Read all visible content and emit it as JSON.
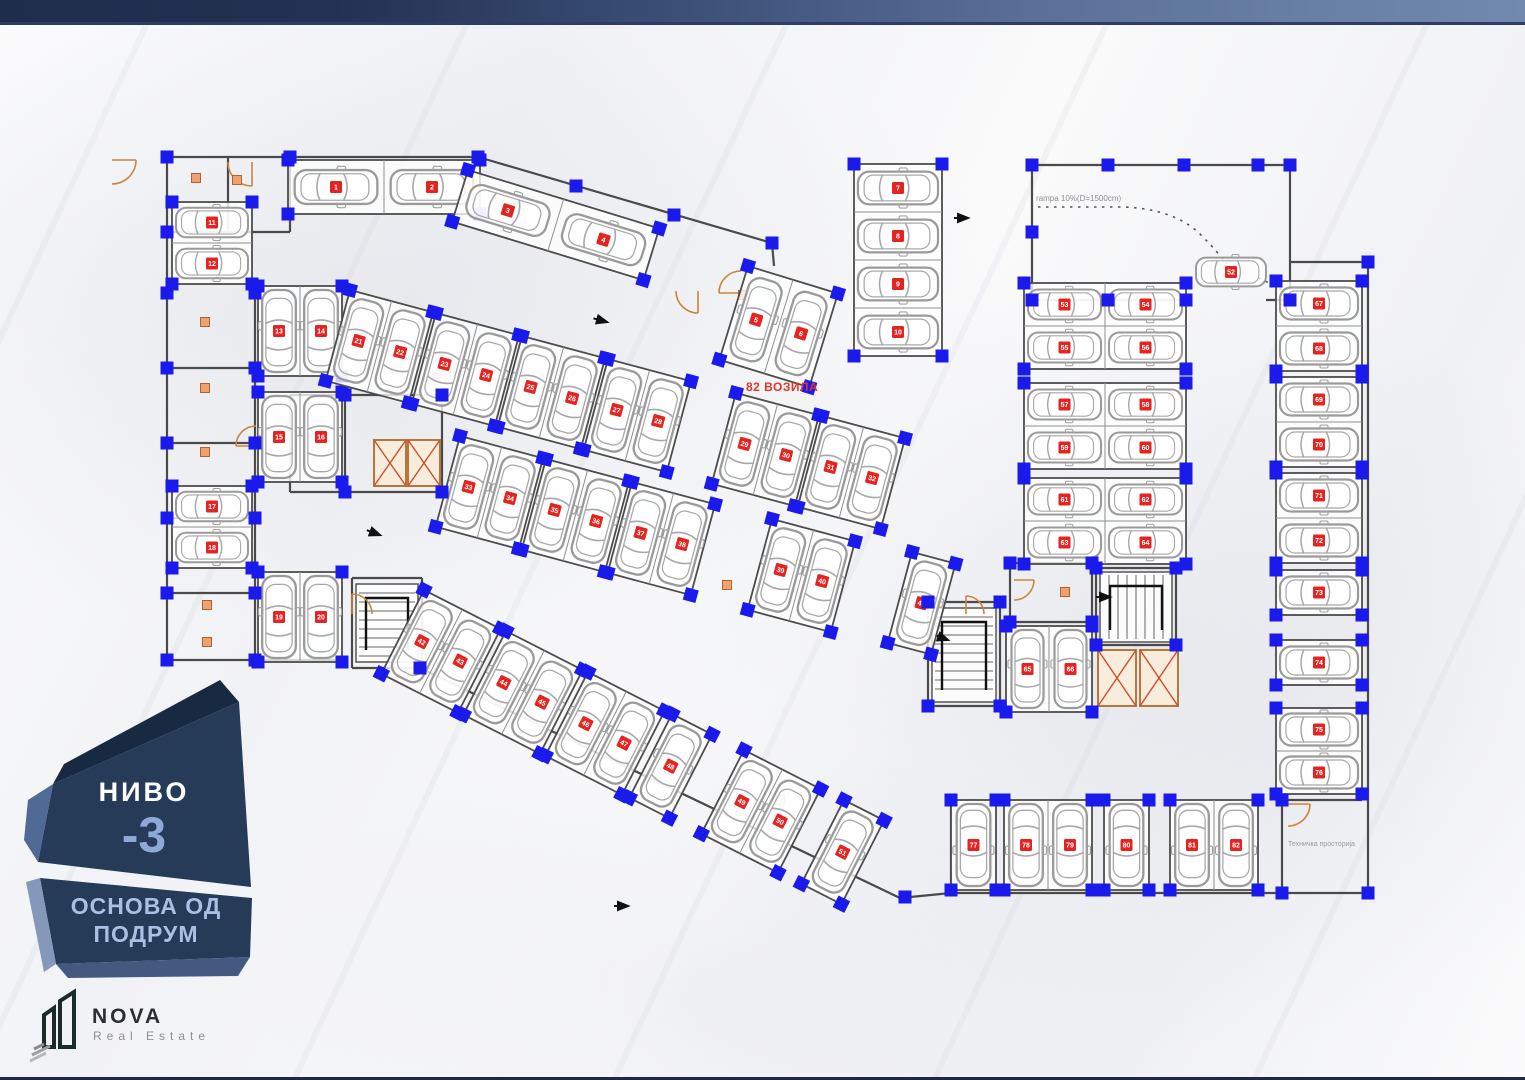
{
  "plan": {
    "vehicle_count_label": "82 ВОЗИЛА",
    "ramp_label": "rampa 10%(D=1500cm)",
    "tech_room_label": "Техничка просторија",
    "colors": {
      "wall": "#4a4a4a",
      "stall_border": "#4c4c4c",
      "stall_divider": "#8f8f8f",
      "car": "#9a9a9a",
      "car_inner": "#a8a8a8",
      "column_blue": "#1a1aec",
      "chip_red": "#e32420",
      "chip_text": "#ffffff",
      "door_orange": "#c8863e",
      "label_square_fill": "#eda271",
      "label_square_border": "#b4612f",
      "elevator_border": "#b8763a",
      "elevator_fill": "#f8ecdc",
      "elevator_x": "#cc4f28",
      "arrow": "#111111",
      "ramp_dash": "#555555"
    },
    "walls": [
      [
        167,
        157,
        478,
        157
      ],
      [
        167,
        157,
        167,
        660
      ],
      [
        167,
        660,
        345,
        660
      ],
      [
        290,
        157,
        290,
        232
      ],
      [
        228,
        157,
        228,
        232
      ],
      [
        167,
        232,
        290,
        232
      ],
      [
        255,
        288,
        255,
        660
      ],
      [
        167,
        368,
        255,
        368
      ],
      [
        167,
        443,
        255,
        443
      ],
      [
        167,
        518,
        255,
        518
      ],
      [
        167,
        593,
        255,
        593
      ],
      [
        478,
        157,
        772,
        243
      ],
      [
        772,
        243,
        774,
        266
      ],
      [
        1032,
        165,
        1290,
        165
      ],
      [
        1032,
        165,
        1032,
        300
      ],
      [
        1290,
        165,
        1290,
        300
      ],
      [
        1032,
        300,
        1186,
        300
      ],
      [
        1266,
        300,
        1290,
        300
      ],
      [
        1290,
        262,
        1368,
        262
      ],
      [
        1368,
        262,
        1368,
        893
      ],
      [
        951,
        893,
        1368,
        893
      ],
      [
        951,
        800,
        951,
        893
      ],
      [
        1282,
        800,
        1282,
        893
      ],
      [
        1282,
        800,
        1362,
        800
      ],
      [
        420,
        668,
        900,
        898
      ],
      [
        900,
        898,
        951,
        893
      ],
      [
        290,
        395,
        442,
        395
      ],
      [
        290,
        395,
        290,
        492
      ],
      [
        442,
        395,
        442,
        492
      ],
      [
        290,
        492,
        442,
        492
      ],
      [
        345,
        395,
        345,
        492
      ],
      [
        1010,
        563,
        1092,
        563
      ],
      [
        1010,
        563,
        1010,
        622
      ],
      [
        1092,
        563,
        1092,
        622
      ],
      [
        1010,
        622,
        1092,
        622
      ],
      [
        1096,
        568,
        1176,
        568
      ],
      [
        1096,
        568,
        1096,
        645
      ],
      [
        1176,
        568,
        1176,
        645
      ],
      [
        1096,
        645,
        1176,
        645
      ],
      [
        352,
        578,
        422,
        578
      ],
      [
        352,
        578,
        352,
        668
      ],
      [
        422,
        578,
        422,
        668
      ],
      [
        352,
        668,
        422,
        668
      ],
      [
        928,
        602,
        1000,
        602
      ],
      [
        928,
        602,
        928,
        706
      ],
      [
        1000,
        602,
        1000,
        706
      ],
      [
        928,
        706,
        1000,
        706
      ]
    ],
    "stairs": [
      [
        356,
        584,
        62,
        78,
        "v"
      ],
      [
        1100,
        572,
        72,
        70,
        "h"
      ],
      [
        932,
        608,
        64,
        94,
        "v"
      ]
    ],
    "elevators": [
      [
        374,
        440,
        32,
        46
      ],
      [
        408,
        440,
        32,
        46
      ],
      [
        1098,
        650,
        38,
        56
      ],
      [
        1140,
        650,
        38,
        56
      ]
    ],
    "doors": [
      [
        112,
        160,
        24,
        0
      ],
      [
        252,
        162,
        24,
        1
      ],
      [
        256,
        446,
        20,
        2
      ],
      [
        352,
        614,
        20,
        3
      ],
      [
        698,
        291,
        22,
        1
      ],
      [
        741,
        293,
        22,
        2
      ],
      [
        1014,
        580,
        20,
        0
      ],
      [
        1288,
        804,
        22,
        0
      ],
      [
        966,
        614,
        18,
        3
      ]
    ],
    "label_squares": [
      [
        196,
        178
      ],
      [
        237,
        180
      ],
      [
        205,
        322
      ],
      [
        205,
        388
      ],
      [
        205,
        452
      ],
      [
        207,
        605
      ],
      [
        207,
        642
      ],
      [
        437,
        377
      ],
      [
        743,
        295
      ],
      [
        1065,
        592
      ],
      [
        727,
        585
      ],
      [
        780,
        800
      ]
    ],
    "arrows": [
      [
        607,
        322,
        195
      ],
      [
        380,
        535,
        200
      ],
      [
        968,
        218,
        180
      ],
      [
        1110,
        597,
        180
      ],
      [
        948,
        640,
        200
      ],
      [
        628,
        906,
        180
      ]
    ],
    "ramp_paths": [
      "M1038,207 H1124 Q1174,209 1200,234 Q1220,254 1226,264",
      "M1258,278 Q1282,288 1294,299"
    ],
    "extra_columns": [
      [
        167,
        157
      ],
      [
        290,
        157
      ],
      [
        167,
        232
      ],
      [
        167,
        293
      ],
      [
        167,
        368
      ],
      [
        167,
        443
      ],
      [
        167,
        518
      ],
      [
        167,
        593
      ],
      [
        167,
        660
      ],
      [
        255,
        293
      ],
      [
        255,
        368
      ],
      [
        255,
        443
      ],
      [
        255,
        518
      ],
      [
        255,
        593
      ],
      [
        255,
        660
      ],
      [
        478,
        157
      ],
      [
        576,
        186
      ],
      [
        674,
        215
      ],
      [
        772,
        243
      ],
      [
        1032,
        165
      ],
      [
        1108,
        165
      ],
      [
        1184,
        165
      ],
      [
        1258,
        165
      ],
      [
        1290,
        165
      ],
      [
        1032,
        232
      ],
      [
        1032,
        300
      ],
      [
        1108,
        300
      ],
      [
        1186,
        300
      ],
      [
        1290,
        300
      ],
      [
        1368,
        262
      ],
      [
        1368,
        893
      ],
      [
        1282,
        893
      ],
      [
        1282,
        800
      ],
      [
        905,
        897
      ],
      [
        420,
        668
      ],
      [
        345,
        395
      ],
      [
        442,
        395
      ],
      [
        345,
        492
      ],
      [
        442,
        492
      ],
      [
        928,
        602
      ],
      [
        1000,
        602
      ],
      [
        928,
        706
      ],
      [
        1000,
        706
      ],
      [
        1096,
        568
      ],
      [
        1176,
        568
      ],
      [
        1096,
        645
      ],
      [
        1176,
        645
      ],
      [
        1010,
        563
      ],
      [
        1092,
        563
      ],
      [
        1010,
        622
      ],
      [
        1092,
        622
      ]
    ],
    "groups": [
      {
        "id": "T1",
        "x": 288,
        "y": 160,
        "nx": 2,
        "ny": 1,
        "sw": 96,
        "sh": 54,
        "dir": "right"
      },
      {
        "id": "T2",
        "x": 468,
        "y": 170,
        "angle": 17,
        "nx": 2,
        "ny": 1,
        "sw": 100,
        "sh": 54,
        "dir": "right"
      },
      {
        "id": "T3",
        "x": 748,
        "y": 266,
        "angle": 17,
        "nx": 2,
        "ny": 1,
        "sw": 47,
        "sh": 98,
        "dir": "up"
      },
      {
        "id": "T4",
        "x": 854,
        "y": 164,
        "nx": 1,
        "ny": 4,
        "sw": 88,
        "sh": 48,
        "dir": "right"
      },
      {
        "id": "L1",
        "x": 172,
        "y": 202,
        "nx": 1,
        "ny": 2,
        "sw": 80,
        "sh": 41,
        "dir": "right"
      },
      {
        "id": "V1",
        "x": 258,
        "y": 286,
        "nx": 2,
        "ny": 1,
        "sw": 42,
        "sh": 90,
        "dir": "up"
      },
      {
        "id": "V2",
        "x": 258,
        "y": 392,
        "nx": 2,
        "ny": 1,
        "sw": 42,
        "sh": 90,
        "dir": "up"
      },
      {
        "id": "L2",
        "x": 172,
        "y": 486,
        "nx": 1,
        "ny": 2,
        "sw": 80,
        "sh": 41,
        "dir": "right"
      },
      {
        "id": "V3",
        "x": 258,
        "y": 572,
        "nx": 2,
        "ny": 1,
        "sw": 42,
        "sh": 90,
        "dir": "up"
      },
      {
        "id": "M1a",
        "x": 350,
        "y": 290,
        "angle": 15,
        "nx": 2,
        "ny": 1,
        "sw": 43,
        "sh": 94,
        "dir": "up"
      },
      {
        "id": "M1b",
        "x": 436,
        "y": 313,
        "angle": 15,
        "nx": 2,
        "ny": 1,
        "sw": 43,
        "sh": 94,
        "dir": "up"
      },
      {
        "id": "M1c",
        "x": 522,
        "y": 336,
        "angle": 15,
        "nx": 2,
        "ny": 1,
        "sw": 43,
        "sh": 94,
        "dir": "up"
      },
      {
        "id": "M1d",
        "x": 608,
        "y": 359,
        "angle": 15,
        "nx": 2,
        "ny": 1,
        "sw": 43,
        "sh": 94,
        "dir": "up"
      },
      {
        "id": "M1e",
        "x": 736,
        "y": 393,
        "angle": 15,
        "nx": 2,
        "ny": 1,
        "sw": 43,
        "sh": 94,
        "dir": "up"
      },
      {
        "id": "M1f",
        "x": 822,
        "y": 416,
        "angle": 15,
        "nx": 2,
        "ny": 1,
        "sw": 43,
        "sh": 94,
        "dir": "up"
      },
      {
        "id": "M2a",
        "x": 460,
        "y": 436,
        "angle": 15,
        "nx": 2,
        "ny": 1,
        "sw": 43,
        "sh": 94,
        "dir": "up"
      },
      {
        "id": "M2b",
        "x": 546,
        "y": 459,
        "angle": 15,
        "nx": 2,
        "ny": 1,
        "sw": 43,
        "sh": 94,
        "dir": "up"
      },
      {
        "id": "M2c",
        "x": 632,
        "y": 482,
        "angle": 15,
        "nx": 2,
        "ny": 1,
        "sw": 43,
        "sh": 94,
        "dir": "up"
      },
      {
        "id": "M2d",
        "x": 772,
        "y": 519,
        "angle": 15,
        "nx": 2,
        "ny": 1,
        "sw": 43,
        "sh": 94,
        "dir": "up"
      },
      {
        "id": "M2e",
        "x": 912,
        "y": 552,
        "angle": 15,
        "nx": 1,
        "ny": 1,
        "sw": 45,
        "sh": 94,
        "dir": "up"
      },
      {
        "id": "B1a",
        "x": 424,
        "y": 590,
        "angle": 27,
        "nx": 2,
        "ny": 1,
        "sw": 43,
        "sh": 94,
        "dir": "up"
      },
      {
        "id": "B1b",
        "x": 506,
        "y": 631,
        "angle": 27,
        "nx": 2,
        "ny": 1,
        "sw": 43,
        "sh": 94,
        "dir": "up"
      },
      {
        "id": "B1c",
        "x": 588,
        "y": 672,
        "angle": 27,
        "nx": 2,
        "ny": 1,
        "sw": 43,
        "sh": 94,
        "dir": "up"
      },
      {
        "id": "B1d",
        "x": 672,
        "y": 714,
        "angle": 27,
        "nx": 1,
        "ny": 1,
        "sw": 45,
        "sh": 94,
        "dir": "up"
      },
      {
        "id": "B1e",
        "x": 744,
        "y": 750,
        "angle": 27,
        "nx": 2,
        "ny": 1,
        "sw": 43,
        "sh": 94,
        "dir": "up"
      },
      {
        "id": "B1f",
        "x": 844,
        "y": 800,
        "angle": 27,
        "nx": 1,
        "ny": 1,
        "sw": 45,
        "sh": 94,
        "dir": "up"
      },
      {
        "id": "RAMP",
        "x": 1192,
        "y": 252,
        "nx": 1,
        "ny": 1,
        "sw": 78,
        "sh": 40,
        "dir": "right",
        "nobox": true
      },
      {
        "id": "A1",
        "x": 1024,
        "y": 283,
        "nx": 2,
        "ny": 2,
        "sw": 81,
        "sh": 43,
        "dir": "right"
      },
      {
        "id": "A2",
        "x": 1024,
        "y": 383,
        "nx": 2,
        "ny": 2,
        "sw": 81,
        "sh": 43,
        "dir": "right"
      },
      {
        "id": "A3",
        "x": 1024,
        "y": 478,
        "nx": 2,
        "ny": 2,
        "sw": 81,
        "sh": 43,
        "dir": "right"
      },
      {
        "id": "AP",
        "x": 1006,
        "y": 626,
        "nx": 2,
        "ny": 1,
        "sw": 43,
        "sh": 86,
        "dir": "up"
      },
      {
        "id": "FR1",
        "x": 1276,
        "y": 281,
        "nx": 1,
        "ny": 2,
        "sw": 86,
        "sh": 45,
        "dir": "right"
      },
      {
        "id": "FR2",
        "x": 1276,
        "y": 377,
        "nx": 1,
        "ny": 2,
        "sw": 86,
        "sh": 45,
        "dir": "right"
      },
      {
        "id": "FR3",
        "x": 1276,
        "y": 473,
        "nx": 1,
        "ny": 2,
        "sw": 86,
        "sh": 45,
        "dir": "right"
      },
      {
        "id": "FR4",
        "x": 1276,
        "y": 570,
        "nx": 1,
        "ny": 1,
        "sw": 86,
        "sh": 45,
        "dir": "right"
      },
      {
        "id": "FR5",
        "x": 1276,
        "y": 640,
        "nx": 1,
        "ny": 1,
        "sw": 86,
        "sh": 45,
        "dir": "right"
      },
      {
        "id": "FR6",
        "x": 1276,
        "y": 708,
        "nx": 1,
        "ny": 2,
        "sw": 86,
        "sh": 43,
        "dir": "right"
      },
      {
        "id": "BR1",
        "x": 951,
        "y": 800,
        "nx": 1,
        "ny": 1,
        "sw": 45,
        "sh": 90,
        "dir": "down"
      },
      {
        "id": "BR2",
        "x": 1004,
        "y": 800,
        "nx": 2,
        "ny": 1,
        "sw": 44,
        "sh": 90,
        "dir": "down"
      },
      {
        "id": "BR3",
        "x": 1104,
        "y": 800,
        "nx": 1,
        "ny": 1,
        "sw": 45,
        "sh": 90,
        "dir": "down"
      },
      {
        "id": "BR4",
        "x": 1170,
        "y": 800,
        "nx": 2,
        "ny": 1,
        "sw": 44,
        "sh": 90,
        "dir": "down"
      }
    ]
  },
  "badge": {
    "level_label": "НИВО",
    "level_value": "-3",
    "subtitle_line1": "ОСНОВА ОД",
    "subtitle_line2": "ПОДРУМ",
    "face_color": "#253b58",
    "accent_color": "#8fa9d6"
  },
  "logo": {
    "name": "NOVA",
    "tagline": "Real Estate"
  }
}
